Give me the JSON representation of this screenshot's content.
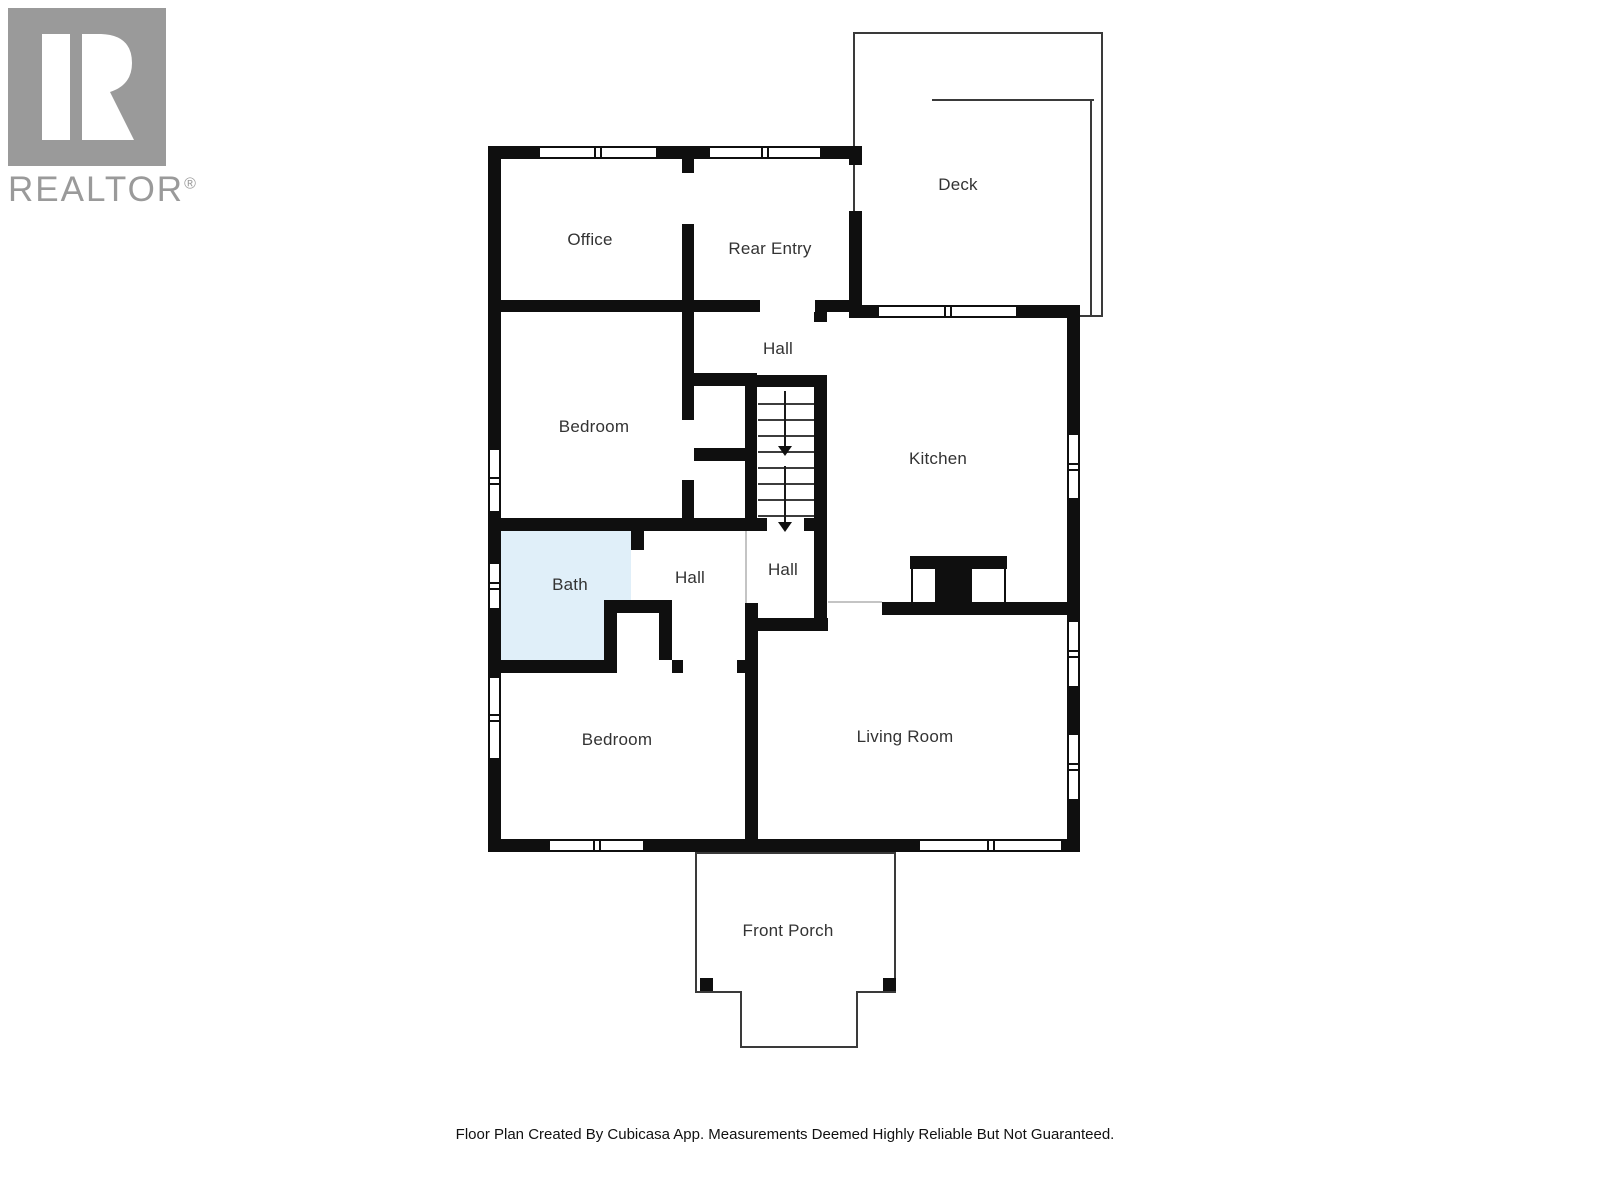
{
  "logo": {
    "brand": "REALTOR",
    "registered_mark": "®",
    "color": "#9a9a9a"
  },
  "floorplan": {
    "rooms": [
      {
        "label": "Office"
      },
      {
        "label": "Rear Entry"
      },
      {
        "label": "Deck"
      },
      {
        "label": "Hall"
      },
      {
        "label": "Bedroom"
      },
      {
        "label": "Kitchen"
      },
      {
        "label": "Bath"
      },
      {
        "label": "Hall"
      },
      {
        "label": "Hall"
      },
      {
        "label": "Bedroom"
      },
      {
        "label": "Living Room"
      },
      {
        "label": "Front Porch"
      }
    ],
    "bath_fill_color": "#e0eff9",
    "wall_color": "#0f0f0f",
    "stairs": {
      "flights": 2,
      "direction": "down"
    }
  },
  "footer": {
    "text": "Floor Plan Created By Cubicasa App. Measurements Deemed Highly Reliable But Not Guaranteed."
  }
}
